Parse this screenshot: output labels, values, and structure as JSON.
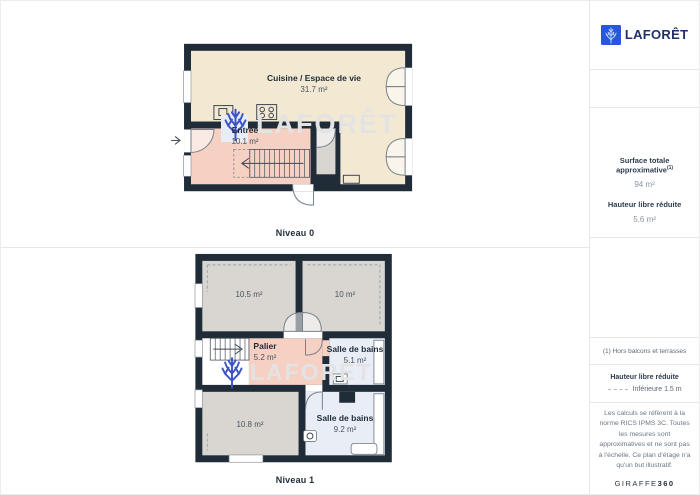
{
  "brand": {
    "name": "LAFORÊT"
  },
  "watermark": {
    "text": "LAFORÊT"
  },
  "floors": [
    {
      "label": "Niveau 0",
      "rooms": [
        {
          "name": "Cuisine / Espace de vie",
          "area": "31.7 m²"
        },
        {
          "name": "Entrée",
          "area": "10.1 m²"
        }
      ]
    },
    {
      "label": "Niveau 1",
      "rooms": [
        {
          "name": "",
          "area": "10.5 m²"
        },
        {
          "name": "",
          "area": "10 m²"
        },
        {
          "name": "Palier",
          "area": "5.2 m²"
        },
        {
          "name": "Salle de bains",
          "area": "5.1 m²"
        },
        {
          "name": "",
          "area": "10.8 m²"
        },
        {
          "name": "Salle de bains",
          "area": "9.2 m²"
        }
      ]
    }
  ],
  "sidebar": {
    "surface": {
      "label": "Surface totale approximative",
      "sup": "(1)",
      "value": "94 m²"
    },
    "height": {
      "label": "Hauteur libre réduite",
      "value": "5.6 m²"
    },
    "footnote": "(1) Hors balcons et terrasses",
    "legend": {
      "title": "Hauteur libre réduite",
      "item": "Inférieure 1.5 m"
    },
    "disclaimer": "Les calculs se réfèrent à la norme RICS IPMS 3C. Toutes les mesures sont approximatives et ne sont pas à l'échelle. Ce plan d'étage n'a qu'un but illustratif.",
    "credit": {
      "name": "GIRAFFE",
      "suffix": "360"
    }
  },
  "colors": {
    "wall": "#202c38",
    "living_cream": "#f3e9d2",
    "hall_salmon": "#f5d0c3",
    "bedroom_gray": "#d9d6d2",
    "bath_blue": "#e9edf5",
    "brand_blue": "#2857d8",
    "tree_blue": "#3d53c6",
    "watermark_gray": "#e3e3e3"
  }
}
